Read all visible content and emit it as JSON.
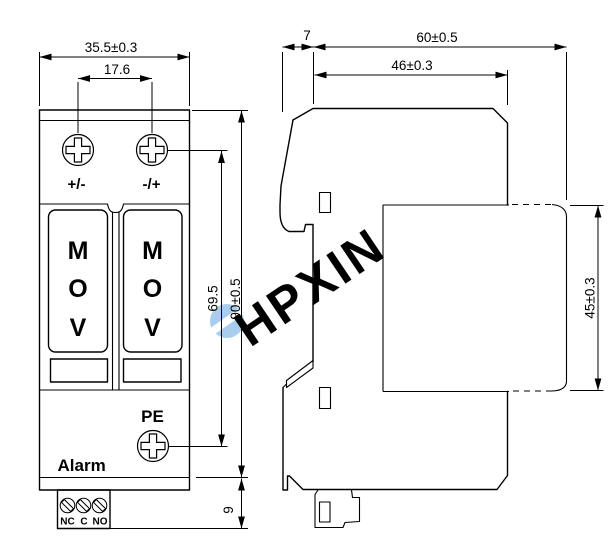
{
  "watermark": {
    "text": "HPXIN"
  },
  "colors": {
    "line": "#000000",
    "indicator_green": "#00f000",
    "watermark_blue": "#a9cdee",
    "background": "#ffffff"
  },
  "front_view": {
    "dim_width": "35.5±0.3",
    "dim_screw_spacing": "17.6",
    "dim_screw_to_pe": "69.5",
    "dim_height": "90±0.5",
    "dim_terminal_block": "9",
    "label_left_terminal": "+/-",
    "label_right_terminal": "-/+",
    "module_letters": [
      "M",
      "O",
      "V"
    ],
    "label_pe": "PE",
    "label_alarm": "Alarm",
    "contact_labels": [
      "NC",
      "C",
      "NO"
    ]
  },
  "side_view": {
    "dim_front_lip": "7",
    "dim_total_depth": "60±0.5",
    "dim_upper_depth": "46±0.3",
    "dim_mount_height": "45±0.3"
  }
}
